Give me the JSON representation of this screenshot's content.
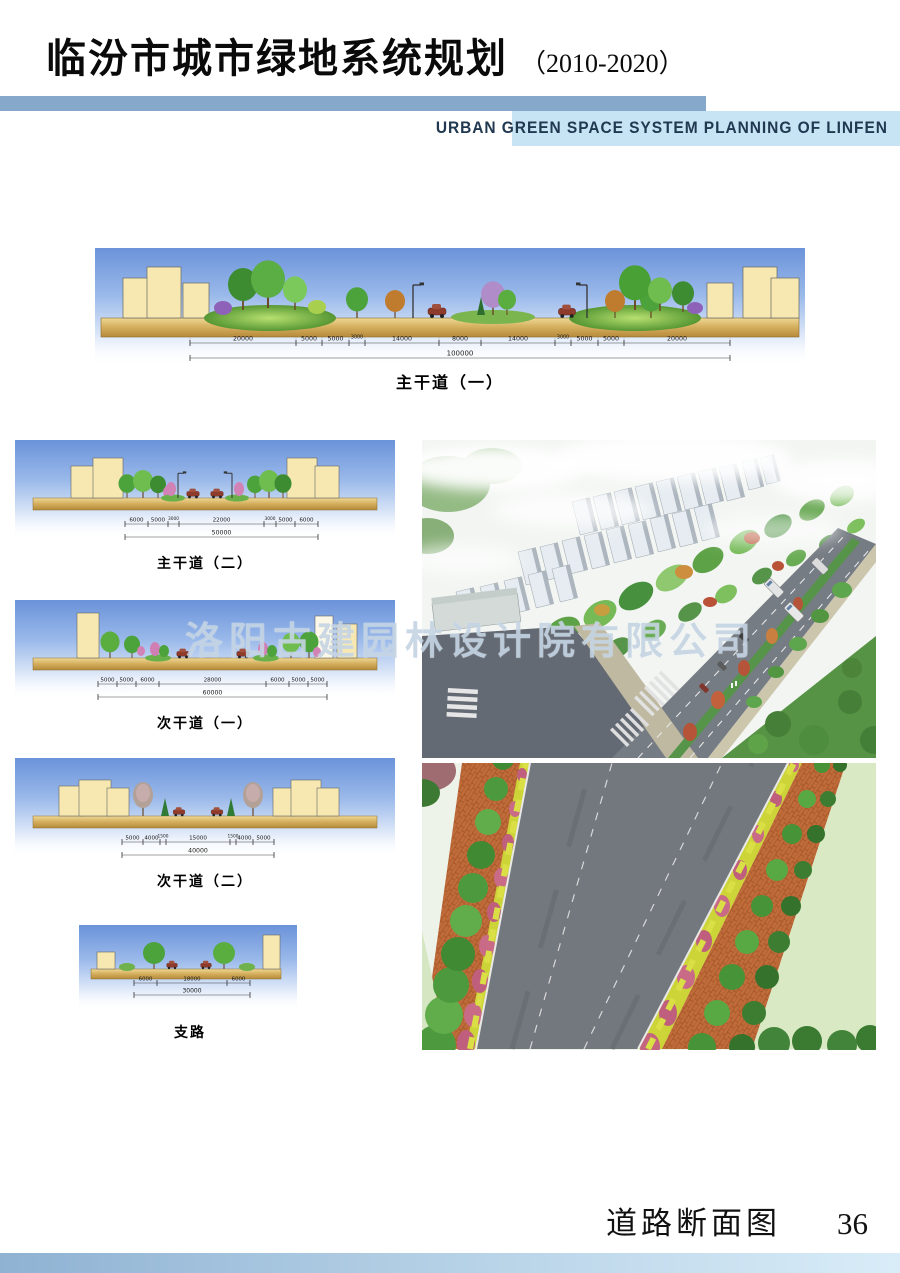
{
  "header": {
    "title": "临汾市城市绿地系统规划",
    "years": "（2010-2020）",
    "subtitle": "URBAN GREEN SPACE SYSTEM PLANNING OF LINFEN"
  },
  "watermark": {
    "text": "洛阳古建园林设计院有限公司"
  },
  "footer": {
    "label": "道路断面图",
    "page_number": "36"
  },
  "cross_sections": {
    "main1": {
      "label": "主干道（一）",
      "total": "100000",
      "dims": [
        "20000",
        "5000",
        "5000",
        "3000",
        "14000",
        "8000",
        "14000",
        "3000",
        "5000",
        "5000",
        "20000"
      ]
    },
    "main2": {
      "label": "主干道（二）",
      "total": "50000",
      "dims": [
        "6000",
        "5000",
        "3000",
        "22000",
        "3000",
        "5000",
        "6000"
      ]
    },
    "secondary1": {
      "label": "次干道（一）",
      "total": "60000",
      "dims": [
        "5000",
        "5000",
        "6000",
        "28000",
        "6000",
        "5000",
        "5000"
      ]
    },
    "secondary2": {
      "label": "次干道（二）",
      "total": "40000",
      "dims": [
        "5000",
        "4000",
        "1500",
        "15000",
        "1500",
        "4000",
        "5000"
      ]
    },
    "branch": {
      "label": "支路",
      "total": "30000",
      "dims": [
        "6000",
        "18000",
        "6000"
      ]
    }
  },
  "colors": {
    "header_bar": "#86a9cb",
    "subtitle_strip": "#c7e4f4",
    "subtitle_text": "#203850",
    "sky_top": "#6b93da",
    "road_fill": "#d6b160",
    "building_fill": "#f6e8b0",
    "grass_green": "#569733",
    "watermark": "#becfe0",
    "bottom_bar": "#8fb2d3"
  }
}
